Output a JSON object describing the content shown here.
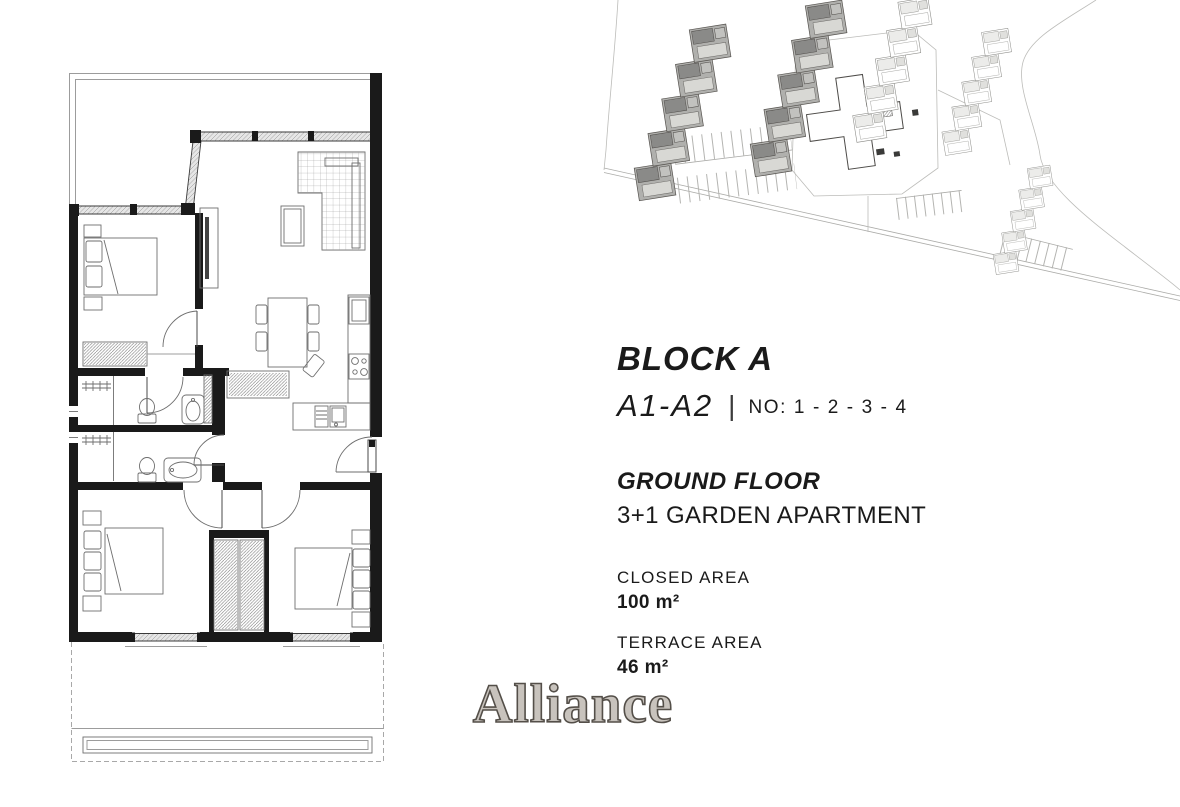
{
  "info_panel": {
    "block_title": "BLOCK A",
    "unit_range": "A1-A2",
    "separator": "|",
    "unit_numbers": "NO: 1 - 2 - 3 - 4",
    "floor_label": "GROUND FLOOR",
    "apartment_type": "3+1 GARDEN APARTMENT",
    "closed_area_label": "CLOSED AREA",
    "closed_area_value": "100 m²",
    "terrace_area_label": "TERRACE AREA",
    "terrace_area_value": "46 m²"
  },
  "brand": {
    "logo_text": "Alliance"
  },
  "colors": {
    "ink": "#1a1a1a",
    "window_fill": "#e6e6e6",
    "site_dark": "#b0b0ad",
    "site_roof": "#8a8a88",
    "logo_fill": "#c8c3bd",
    "logo_outline": "#544f49"
  }
}
